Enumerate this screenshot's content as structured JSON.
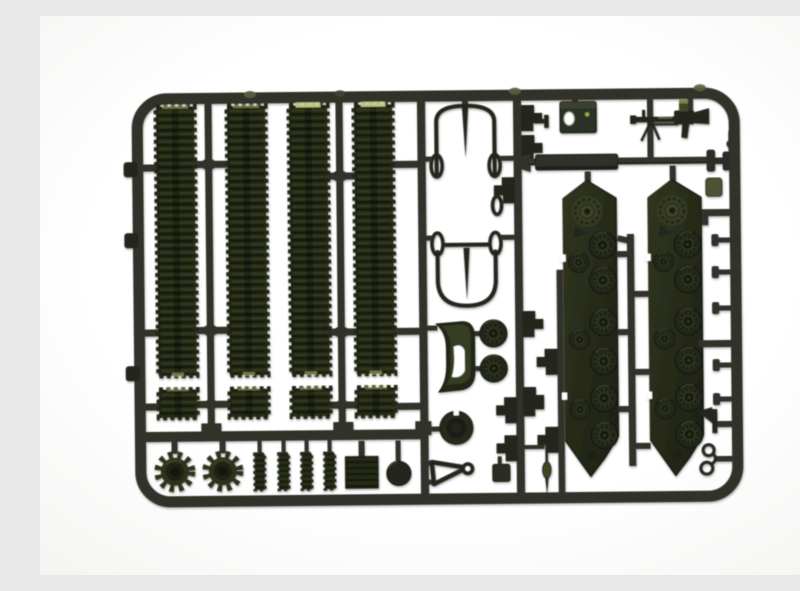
{
  "meta": {
    "type": "photograph",
    "subject": "Injection-molded plastic model kit sprue with tank parts, dark olive green plastic on a white background",
    "alt": "Model kit sprue frame holding tank tracks, drive sprockets, suspension side panels with road wheels, a gun barrel, a machine gun, tow cables and small fittings"
  },
  "palette": {
    "background": "#ffffff",
    "runner": "#30332b",
    "runner_dark": "#24271f",
    "runner_light": "#4a4e40",
    "olive": "#2d321e",
    "olive_dark": "#1c2112",
    "olive_light": "#3f4628",
    "flash": "#c9d18f",
    "tab_olive": "#4d5233",
    "wheel_face": "#22261a",
    "wheel_ring": "#2c311f",
    "wheel_hub": "#14170c",
    "hole_white": "#ffffff",
    "accent_dot": "#9aa742"
  },
  "parts": [
    {
      "name": "track-strip-long",
      "qty": 4,
      "location": "left section, vertical"
    },
    {
      "name": "track-strip-short",
      "qty": 4,
      "location": "left section, below long strips"
    },
    {
      "name": "drive-sprocket-wheel",
      "qty": 2,
      "location": "bottom-left row"
    },
    {
      "name": "ribbed-cylinder",
      "qty": 4,
      "location": "bottom-left row"
    },
    {
      "name": "grille-plate",
      "qty": 1,
      "location": "bottom-left row"
    },
    {
      "name": "dome-cap",
      "qty": 1,
      "location": "bottom-left row"
    },
    {
      "name": "tow-cable-with-eyelets",
      "qty": 2,
      "location": "middle column"
    },
    {
      "name": "curved-fender",
      "qty": 1,
      "location": "middle column"
    },
    {
      "name": "idler-wheel",
      "qty": 2,
      "location": "middle column"
    },
    {
      "name": "turret-ring",
      "qty": 1,
      "location": "middle column"
    },
    {
      "name": "tow-triangle",
      "qty": 1,
      "location": "middle column, bottom"
    },
    {
      "name": "antenna",
      "qty": 1,
      "location": "middle column, bottom"
    },
    {
      "name": "engine-hatch-box",
      "qty": 1,
      "location": "top right"
    },
    {
      "name": "machine-gun",
      "qty": 1,
      "location": "top right"
    },
    {
      "name": "gun-barrel",
      "qty": 1,
      "location": "right section, horizontal"
    },
    {
      "name": "suspension-side-panel-with-road-wheels",
      "qty": 2,
      "location": "right section, vertical"
    },
    {
      "name": "road-wheel-large",
      "qty": 12,
      "location": "molded on suspension panels"
    },
    {
      "name": "return-roller-small",
      "qty": 6,
      "location": "molded on suspension panels"
    },
    {
      "name": "step-bracket",
      "qty": 10,
      "location": "middle rails"
    },
    {
      "name": "mounting-stud",
      "qty": 5,
      "location": "right rail"
    },
    {
      "name": "tool-head",
      "qty": 1,
      "location": "bottom right"
    },
    {
      "name": "tow-hook-rings",
      "qty": 1,
      "location": "bottom right"
    },
    {
      "name": "sprue-gate-tab",
      "qty": 3,
      "location": "outer left rail"
    }
  ]
}
